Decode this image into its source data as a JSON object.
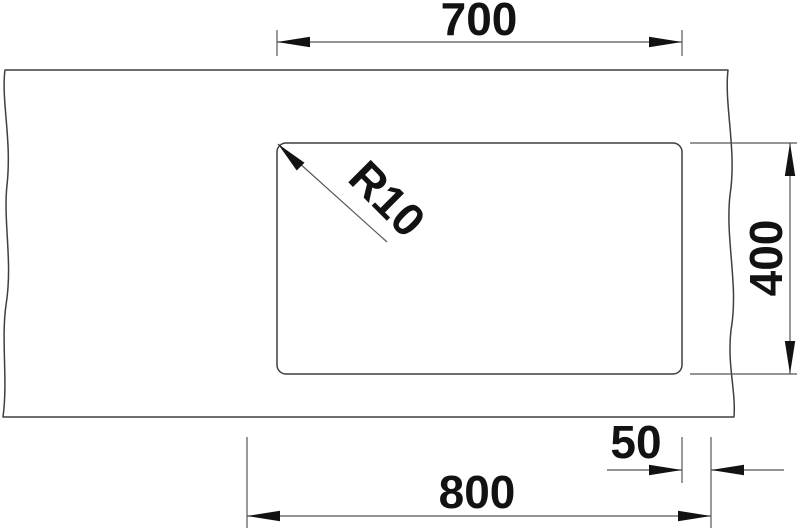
{
  "drawing": {
    "description": "Technical top-view dimension drawing of a rectangular sink bowl cutout with break lines on left and right edges",
    "colors": {
      "background": "#ffffff",
      "outline": "#3f3f3f",
      "dimension_line": "#565656",
      "ink": "#121212"
    },
    "dimensions": {
      "top_width": {
        "value": "700"
      },
      "right_depth": {
        "value": "400"
      },
      "bottom_length": {
        "value": "800"
      },
      "bottom_right_offset": {
        "value": "50"
      },
      "corner_radius": {
        "value": "R10"
      }
    }
  }
}
